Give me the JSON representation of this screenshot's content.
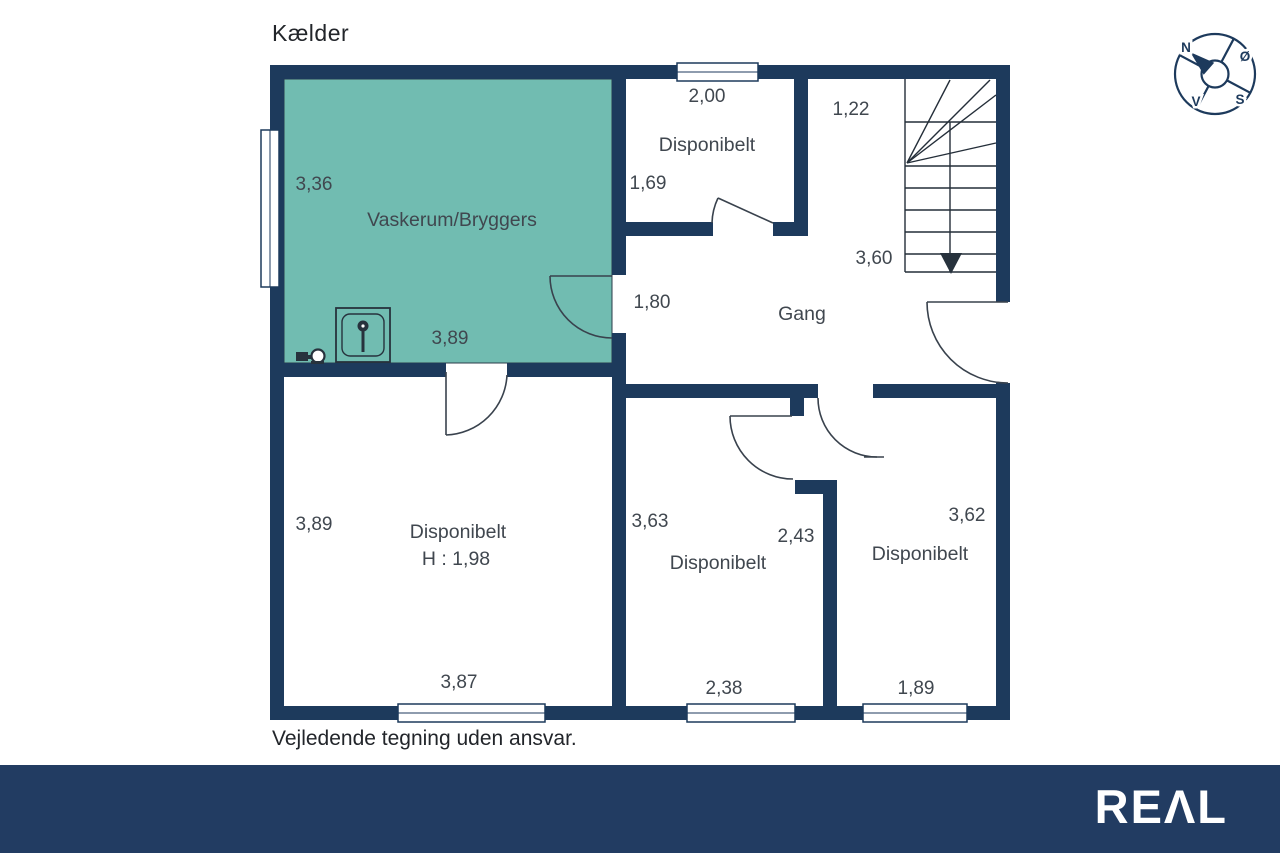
{
  "title": "Kælder",
  "disclaimer": "Vejledende tegning uden ansvar.",
  "logo_text": "REΛL",
  "colors": {
    "wall_navy": "#1d3a5c",
    "room_teal": "#71bcb1",
    "footer_navy": "#223c62",
    "plan_text": "#40474f"
  },
  "compass": {
    "n": "N",
    "oe": "Ø",
    "v": "V",
    "s": "S"
  },
  "rooms": {
    "vaskerum": {
      "name": "Vaskerum/Bryggers",
      "dim_left": "3,36",
      "dim_bottom": "3,89"
    },
    "top_disp": {
      "name": "Disponibelt",
      "dim_top": "2,00",
      "dim_left": "1,69"
    },
    "stairs": {
      "dim_top": "1,22",
      "dim_len": "3,60"
    },
    "gang": {
      "name": "Gang",
      "dim_left": "1,80"
    },
    "bottom_left": {
      "name": "Disponibelt",
      "height_note": "H : 1,98",
      "dim_left": "3,89",
      "dim_bottom": "3,87"
    },
    "bottom_middle": {
      "name": "Disponibelt",
      "dim_left": "3,63",
      "dim_right": "2,43",
      "dim_bottom": "2,38"
    },
    "bottom_right": {
      "name": "Disponibelt",
      "dim_right": "3,62",
      "dim_bottom": "1,89"
    }
  }
}
